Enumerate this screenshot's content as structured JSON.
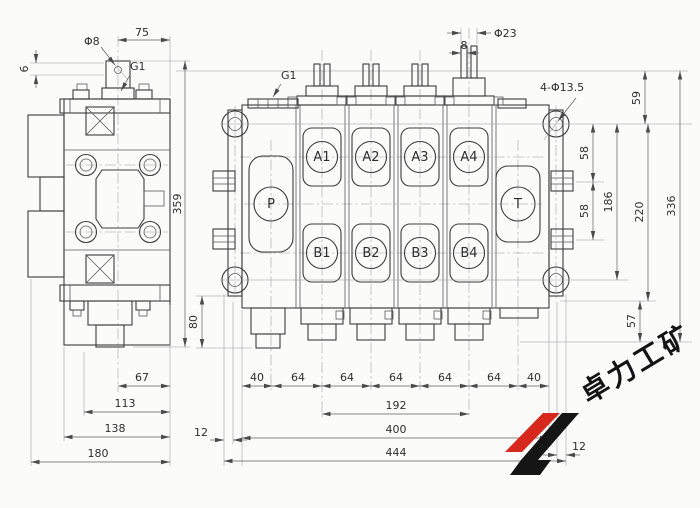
{
  "drawing_type": "hydraulic-multiway-valve-engineering-drawing",
  "ports": {
    "p": "P",
    "t": "T",
    "a": [
      "A1",
      "A2",
      "A3",
      "A4"
    ],
    "b": [
      "B1",
      "B2",
      "B3",
      "B4"
    ]
  },
  "labels": {
    "phi8": "Φ8",
    "phi23": "Φ23",
    "g1_side": "G1",
    "g1_front": "G1",
    "holes": "4-Φ13.5"
  },
  "dims": {
    "d75": "75",
    "d6": "6",
    "d8": "8",
    "d359": "359",
    "d67": "67",
    "d113": "113",
    "d138": "138",
    "d180": "180",
    "d80": "80",
    "d59": "59",
    "d58a": "58",
    "d58b": "58",
    "d186": "186",
    "d220": "220",
    "d336": "336",
    "d57": "57",
    "chain": [
      "40",
      "64",
      "64",
      "64",
      "64",
      "64",
      "40"
    ],
    "d192": "192",
    "d400": "400",
    "d444": "444",
    "d12l": "12",
    "d12r": "12"
  },
  "watermark": {
    "text": "卓力工矿",
    "logo_red": "#d7281e",
    "logo_black": "#151515"
  },
  "colors": {
    "line": "#3c3c3c",
    "paper": "#fbfbfa"
  }
}
